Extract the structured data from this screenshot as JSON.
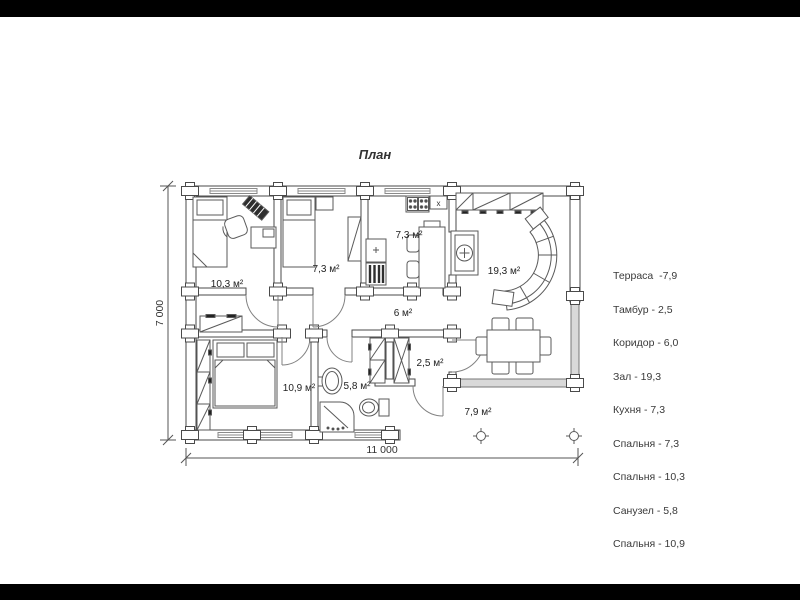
{
  "title": "План",
  "legend": {
    "items": [
      "Терраса  -7,9",
      "Тамбур - 2,5",
      "Коридор - 6,0",
      "Зал - 19,3",
      "Кухня - 7,3",
      "Спальня - 7,3",
      "Спальня - 10,3",
      "Санузел - 5,8",
      "Спальня - 10,9"
    ]
  },
  "dimensions": {
    "width": "11 000",
    "height": "7 000"
  },
  "rooms": {
    "bedroom1": "10,3 м²",
    "bedroom2": "7,3 м²",
    "kitchen": "7,3 м²",
    "hall": "19,3 м²",
    "corridor": "6 м²",
    "bedroom3": "10,9 м²",
    "bathroom": "5,8 м²",
    "vestibule": "2,5 м²",
    "terrace": "7,9 м²"
  },
  "markers": {
    "kitchen_x": "x"
  },
  "colors": {
    "line": "#4a4a4a",
    "window": "#d9d9d9",
    "bar": "#000000"
  }
}
